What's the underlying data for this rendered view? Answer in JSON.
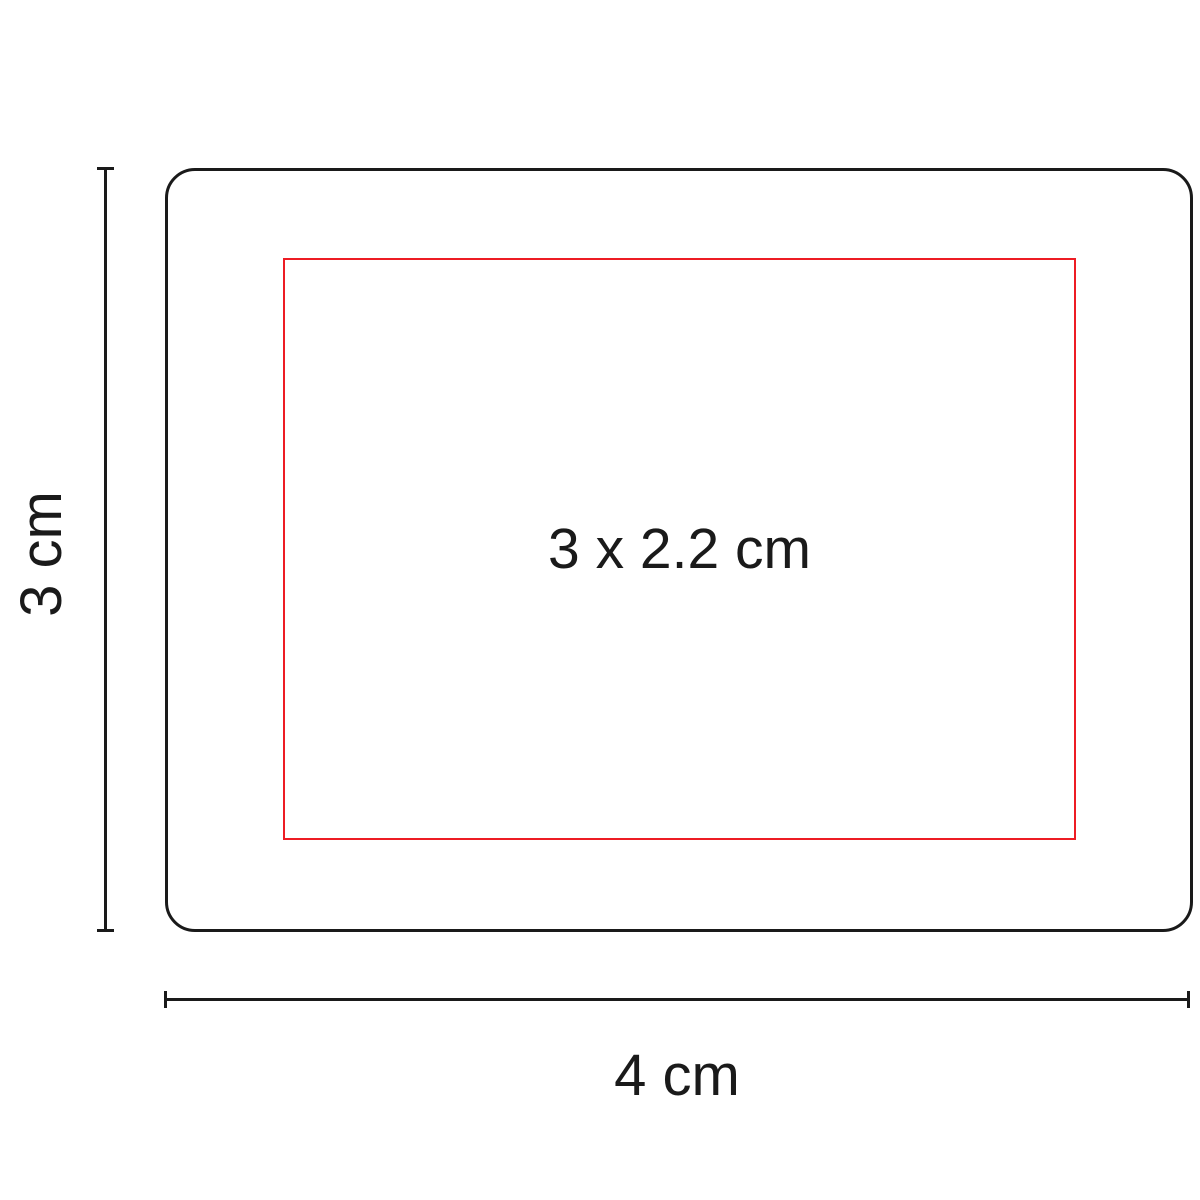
{
  "colors": {
    "background": "#ffffff",
    "outline": "#1a1a1a",
    "imprint": "#ed1c24",
    "text": "#1a1a1a"
  },
  "diagram": {
    "type": "product-imprint-dimension-diagram",
    "product": {
      "width_label": "4 cm",
      "height_label": "3 cm"
    },
    "imprint_area": {
      "label": "3 x 2.2 cm"
    }
  }
}
